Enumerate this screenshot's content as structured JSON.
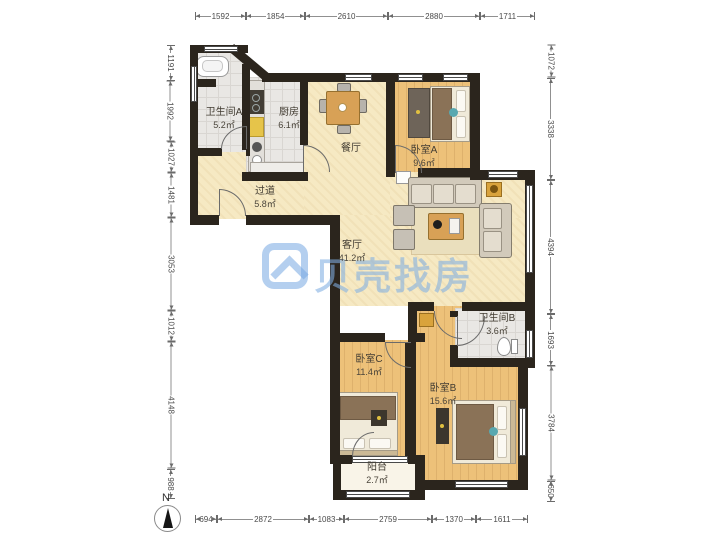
{
  "watermark": {
    "brand": "贝壳找房"
  },
  "compass": {
    "label": "N"
  },
  "rooms": [
    {
      "id": "bathroom-a",
      "name": "卫生间A",
      "area": "5.2㎡"
    },
    {
      "id": "kitchen",
      "name": "厨房",
      "area": "6.1㎡"
    },
    {
      "id": "dining",
      "name": "餐厅",
      "area": ""
    },
    {
      "id": "bedroom-a",
      "name": "卧室A",
      "area": "9.6㎡"
    },
    {
      "id": "hallway",
      "name": "过道",
      "area": "5.8㎡"
    },
    {
      "id": "living",
      "name": "客厅",
      "area": "41.2㎡"
    },
    {
      "id": "bathroom-b",
      "name": "卫生间B",
      "area": "3.6㎡"
    },
    {
      "id": "bedroom-c",
      "name": "卧室C",
      "area": "11.4㎡"
    },
    {
      "id": "bedroom-b",
      "name": "卧室B",
      "area": "15.6㎡"
    },
    {
      "id": "balcony",
      "name": "阳台",
      "area": "2.7㎡"
    }
  ],
  "dimensions": {
    "top": [
      "1592",
      "1854",
      "2610",
      "2880",
      "1711"
    ],
    "bottom": [
      "694",
      "2872",
      "1083",
      "2759",
      "1370",
      "1611"
    ],
    "left": [
      "1191",
      "1992",
      "1027",
      "1481",
      "3053",
      "1012",
      "4148",
      "988"
    ],
    "right": [
      "1072",
      "3338",
      "4394",
      "1693",
      "3784",
      "650"
    ]
  },
  "colors": {
    "wall": "#2b251d",
    "wood_floor": "#edc179",
    "tile_floor": "#e9e7e4",
    "living_floor": "#f6e9c3",
    "watermark_blue": "#80aee2",
    "accent_teal": "#58a8b0",
    "accent_gold": "#d9a33c"
  }
}
